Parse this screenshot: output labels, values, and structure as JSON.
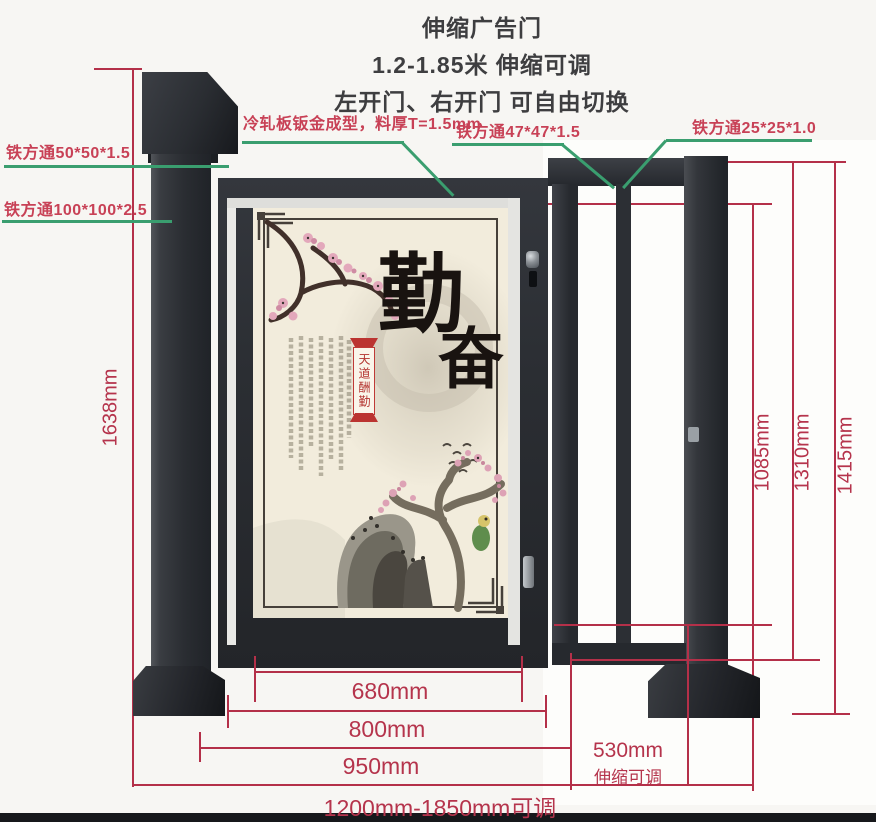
{
  "title": {
    "line1": "伸缩广告门",
    "line2": "1.2-1.85米 伸缩可调",
    "line3": "左开门、右开门 可自由切换"
  },
  "callouts": {
    "cold_rolled": "冷轧板钣金成型，料厚T=1.5mm",
    "tube_47": "铁方通47*47*1.5",
    "tube_25": "铁方通25*25*1.0",
    "tube_50": "铁方通50*50*1.5",
    "tube_100": "铁方通100*100*2.5"
  },
  "dimensions": {
    "total_height": "1638mm",
    "opening_height": "1085mm",
    "frame_height": "1310mm",
    "post_height": "1415mm",
    "panel_width": "680mm",
    "door_width": "800mm",
    "leaf_width": "950mm",
    "ext_width": "530mm",
    "ext_note": "伸缩可调",
    "total_width": "1200mm-1850mm可调"
  },
  "artwork": {
    "calligraphy_1": "勤",
    "calligraphy_2": "奋",
    "banner": "天道酬勤"
  },
  "colors": {
    "gate_metal": "#2b2e33",
    "dimension_line": "#b43049",
    "callout_text": "#c84156",
    "callout_line": "#3a9e6f",
    "canvas": "#f1ead9"
  }
}
